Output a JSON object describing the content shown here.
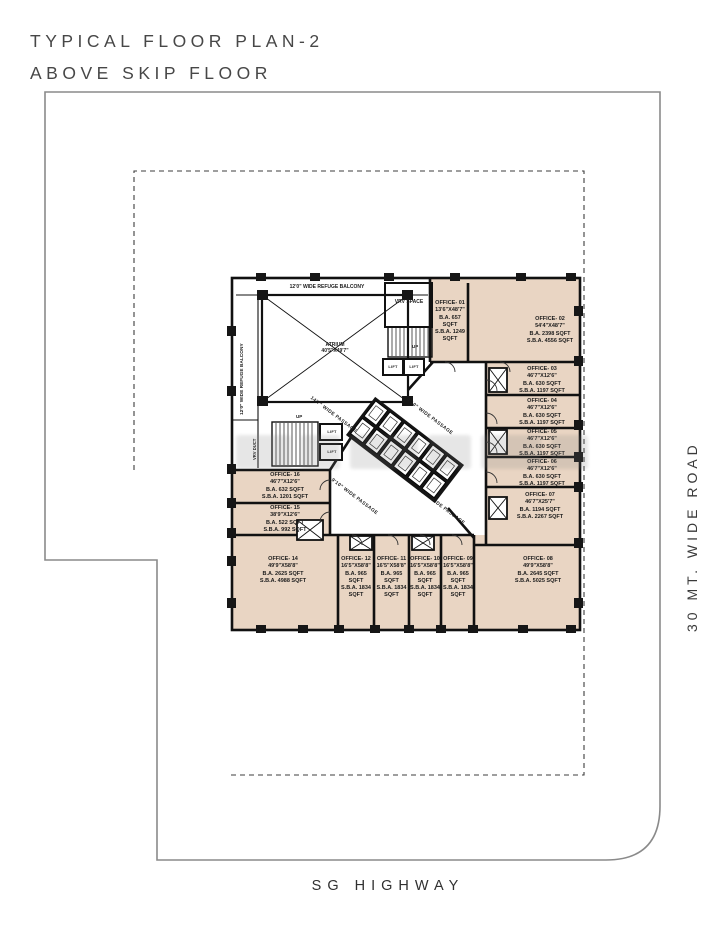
{
  "colors": {
    "office_fill": "#e9d5c3",
    "wall": "#111111",
    "boundary": "#8a8a8a"
  },
  "title": {
    "line1": "TYPICAL FLOOR PLAN-2",
    "line2": "ABOVE SKIP FLOOR"
  },
  "roads": {
    "right_road": "30 MT. WIDE ROAD",
    "bottom_road": "SG HIGHWAY"
  },
  "core": {
    "atrium_name": "ATRIUM",
    "atrium_dim": "40'5\"X49'7\"",
    "refuge_top": "12'0\" WIDE REFUGE BALCONY",
    "refuge_left": "12'0\" WIDE REFUGE BALCONY",
    "vrv_space": "VRV SPACE",
    "vrv_duct": "VRV DUCT",
    "lift": "LIFT",
    "up": "UP",
    "passages": {
      "p1": "14'7\" WIDE PASSAGE",
      "p2": "9'10\" WIDE PASSAGE",
      "p3": "9'10\" WIDE PASSAGE",
      "p4": "22'0\" WIDE PASSAGE"
    }
  },
  "offices": [
    {
      "name": "OFFICE- 01",
      "dim": "13'6\"X48'7\"",
      "ba": "B.A. 657 SQFT",
      "sba": "S.B.A. 1249 SQFT"
    },
    {
      "name": "OFFICE- 02",
      "dim": "54'4\"X48'7\"",
      "ba": "B.A. 2398 SQFT",
      "sba": "S.B.A. 4556 SQFT"
    },
    {
      "name": "OFFICE- 03",
      "dim": "46'7\"X12'6\"",
      "ba": "B.A. 630 SQFT",
      "sba": "S.B.A. 1197 SQFT"
    },
    {
      "name": "OFFICE- 04",
      "dim": "46'7\"X12'6\"",
      "ba": "B.A. 630 SQFT",
      "sba": "S.B.A. 1197 SQFT"
    },
    {
      "name": "OFFICE- 05",
      "dim": "46'7\"X12'6\"",
      "ba": "B.A. 630 SQFT",
      "sba": "S.B.A. 1197 SQFT"
    },
    {
      "name": "OFFICE- 06",
      "dim": "46'7\"X12'6\"",
      "ba": "B.A. 630 SQFT",
      "sba": "S.B.A. 1197 SQFT"
    },
    {
      "name": "OFFICE- 07",
      "dim": "46'7\"X25'7\"",
      "ba": "B.A. 1194 SQFT",
      "sba": "S.B.A. 2267 SQFT"
    },
    {
      "name": "OFFICE- 08",
      "dim": "49'9\"X58'8\"",
      "ba": "B.A. 2645 SQFT",
      "sba": "S.B.A. 5025 SQFT"
    },
    {
      "name": "OFFICE- 09",
      "dim": "16'5\"X58'8\"",
      "ba": "B.A. 965 SQFT",
      "sba": "S.B.A. 1834 SQFT"
    },
    {
      "name": "OFFICE- 10",
      "dim": "16'5\"X58'8\"",
      "ba": "B.A. 965 SQFT",
      "sba": "S.B.A. 1834 SQFT"
    },
    {
      "name": "OFFICE- 11",
      "dim": "16'5\"X58'8\"",
      "ba": "B.A. 965 SQFT",
      "sba": "S.B.A. 1834 SQFT"
    },
    {
      "name": "OFFICE- 12",
      "dim": "16'5\"X58'8\"",
      "ba": "B.A. 965 SQFT",
      "sba": "S.B.A. 1834 SQFT"
    },
    {
      "name": "OFFICE- 14",
      "dim": "49'9\"X58'8\"",
      "ba": "B.A. 2625 SQFT",
      "sba": "S.B.A. 4988 SQFT"
    },
    {
      "name": "OFFICE- 15",
      "dim": "38'9\"X12'6\"",
      "ba": "B.A. 522 SQFT",
      "sba": "S.B.A. 992 SQFT"
    },
    {
      "name": "OFFICE- 16",
      "dim": "46'7\"X12'6\"",
      "ba": "B.A. 632 SQFT",
      "sba": "S.B.A. 1201 SQFT"
    }
  ]
}
